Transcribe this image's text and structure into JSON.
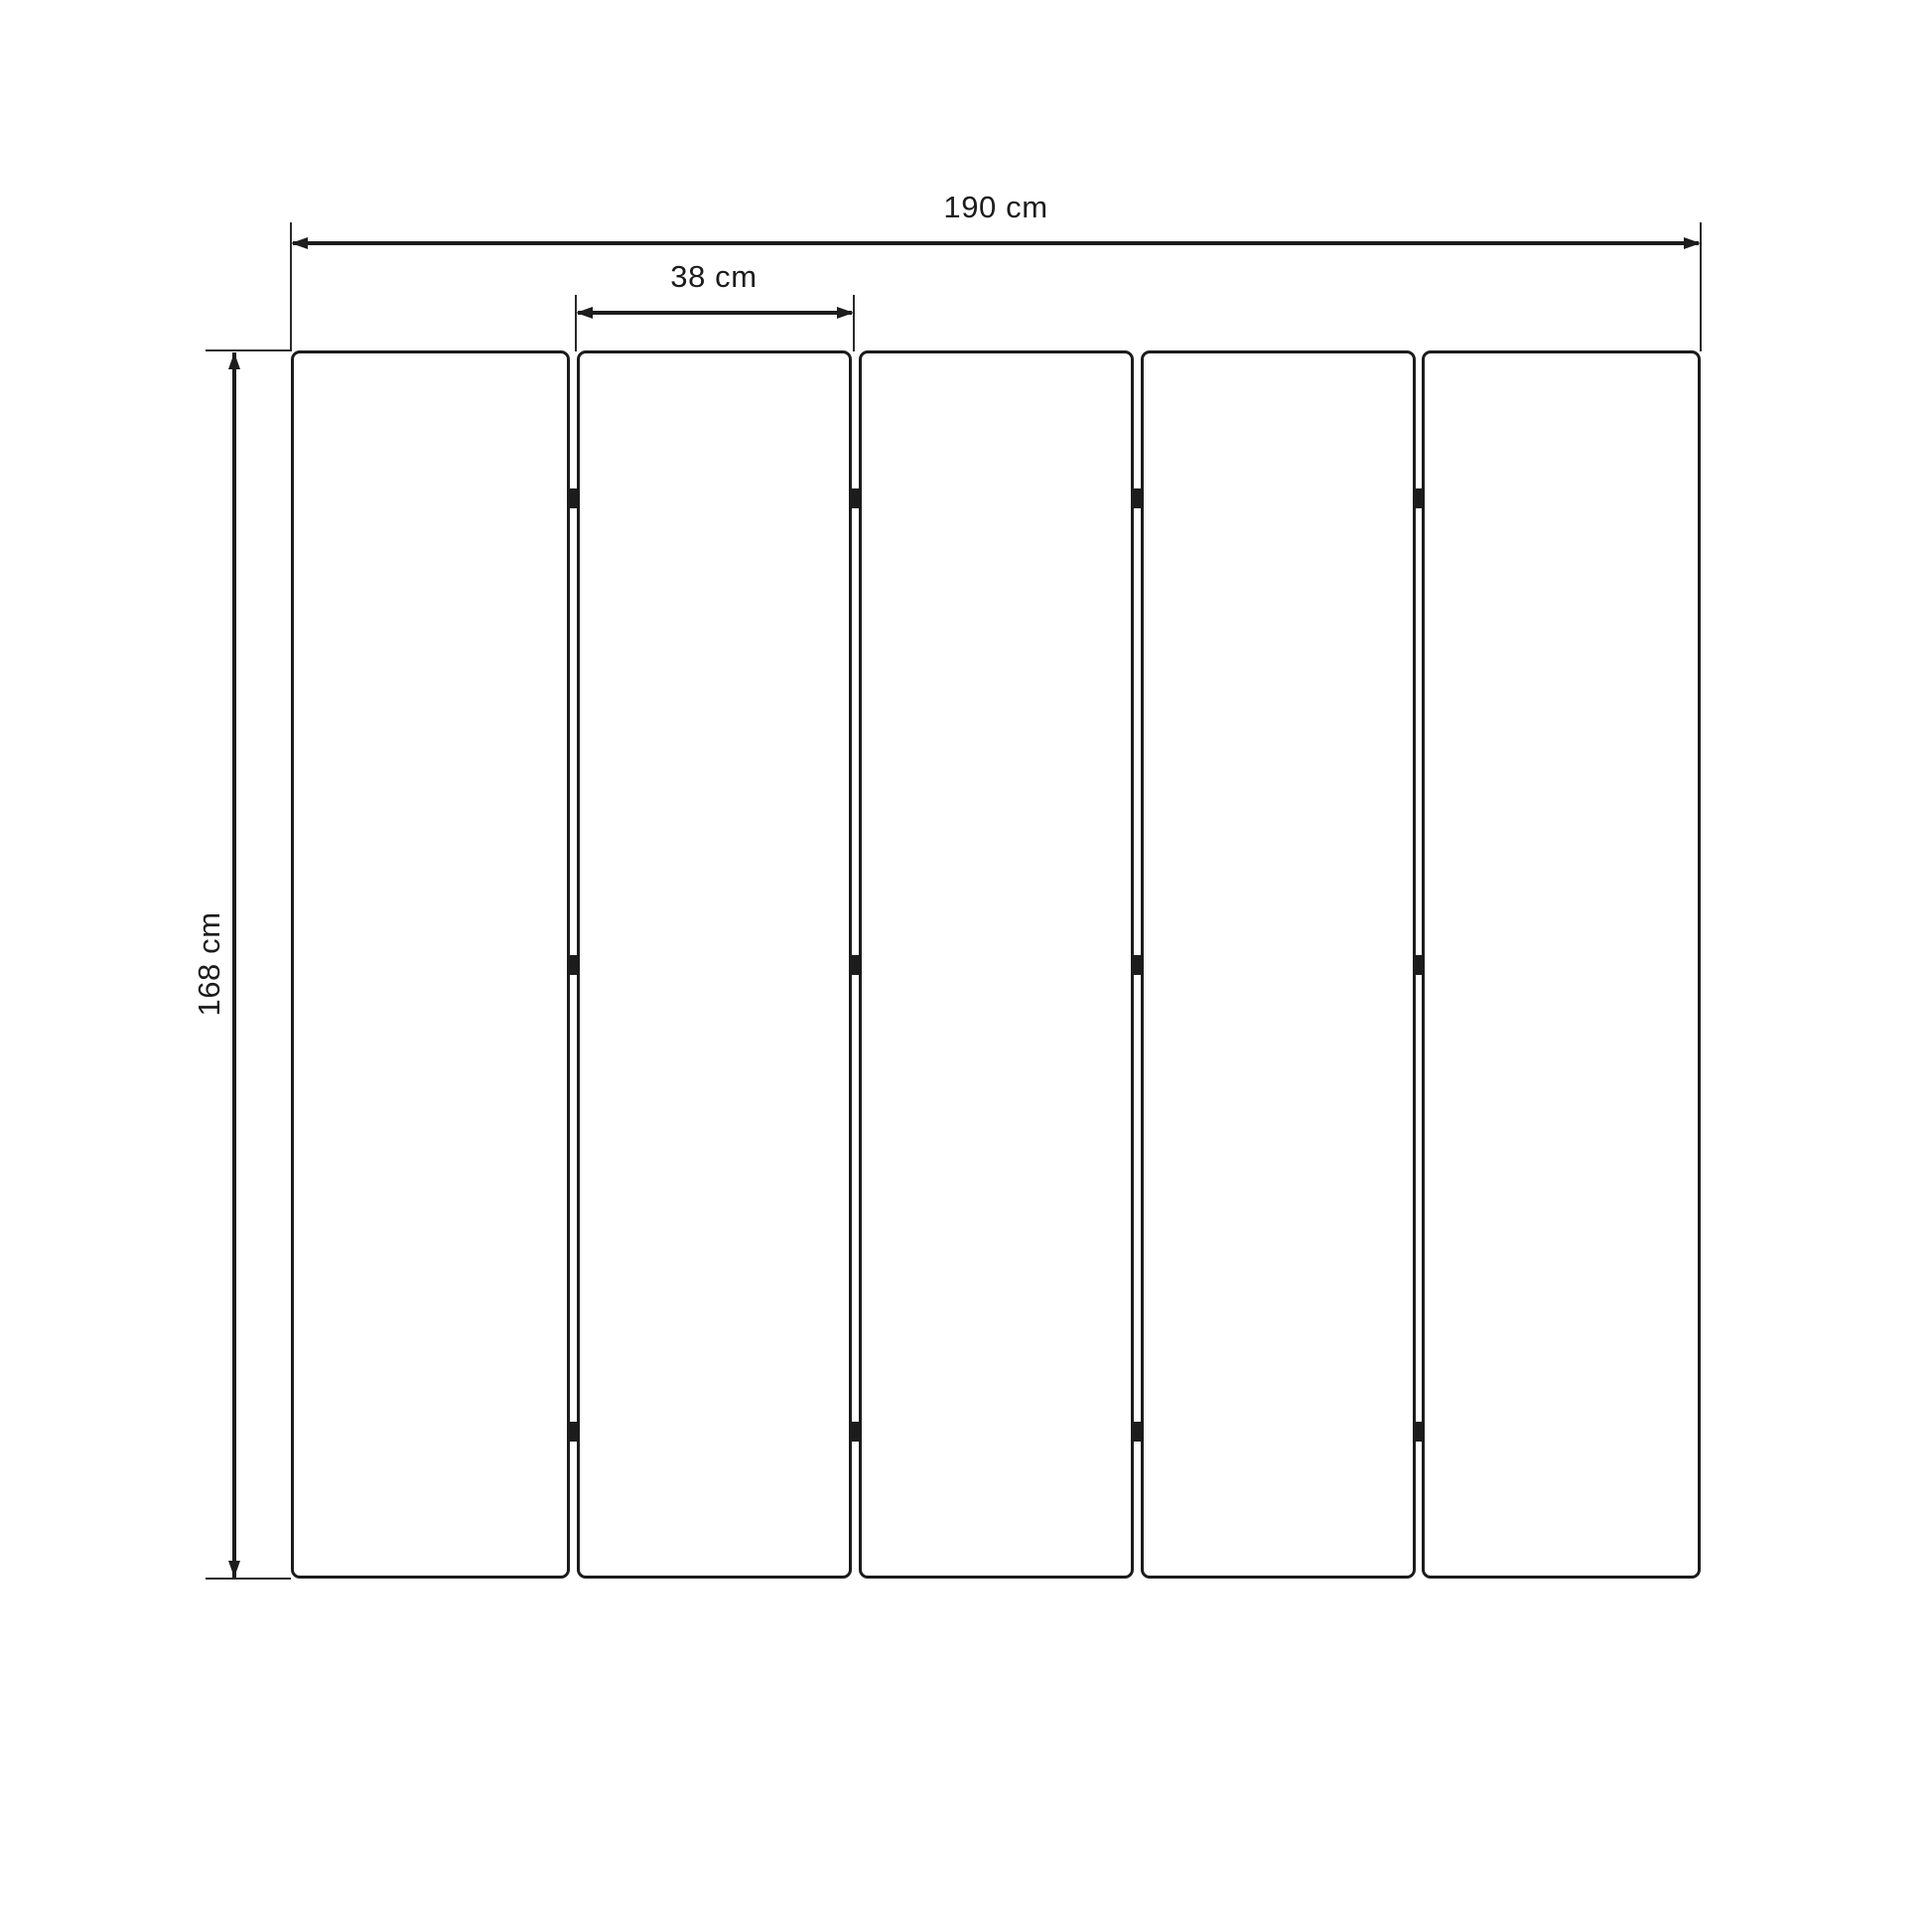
{
  "drawing": {
    "background_color": "#ffffff",
    "line_color": "#1c1c1c",
    "dimensions": {
      "total_width": {
        "label": "190 cm",
        "value": 190,
        "unit": "cm"
      },
      "panel_width": {
        "label": "38 cm",
        "value": 38,
        "unit": "cm"
      },
      "height": {
        "label": "168 cm",
        "value": 168,
        "unit": "cm"
      }
    },
    "panels": {
      "count": 5,
      "gap_count": 4,
      "hinge_rows_per_gap": 3
    }
  }
}
